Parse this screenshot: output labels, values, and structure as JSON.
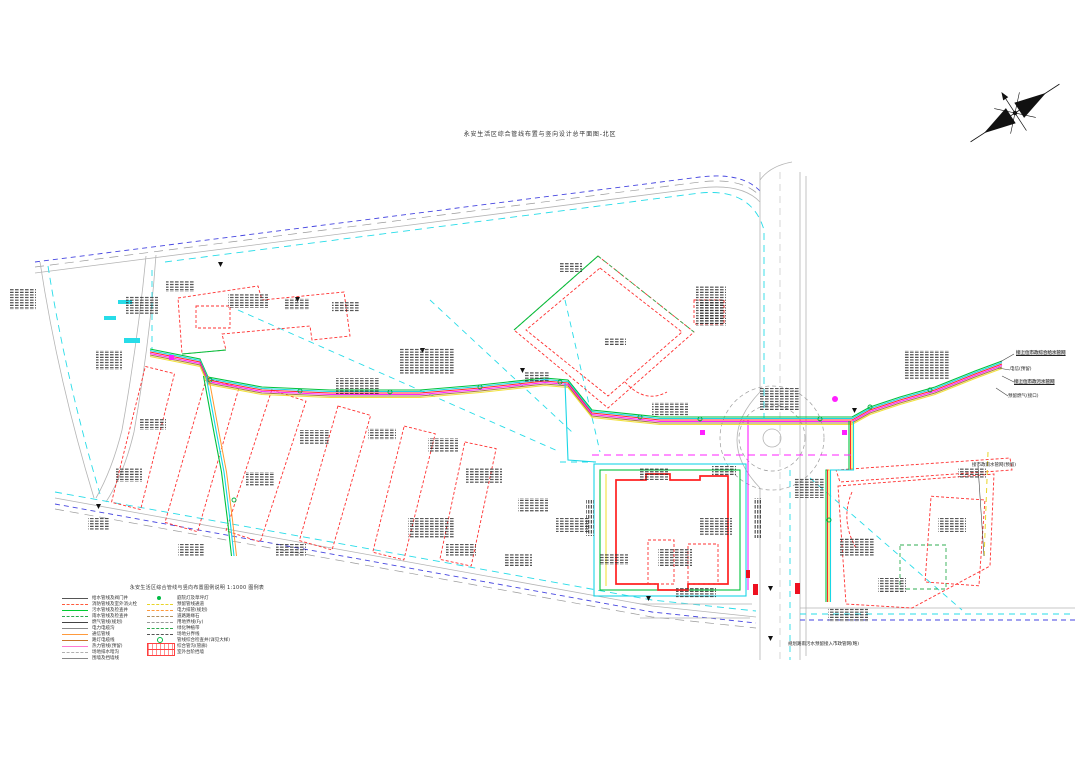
{
  "title": "永安生活区综合管线布置与竖向设计总平面图-北区",
  "compass": {
    "icon": "north-arrow"
  },
  "legend": {
    "title": "永安生活区综合管线与竖向布置图例说明 1:1000 图例表",
    "left_items": [
      {
        "label": "给水管线及阀门井",
        "color": "#555555",
        "style": "solid"
      },
      {
        "label": "消防管线及室外消火栓",
        "color": "#ff5a3c",
        "style": "dashed"
      },
      {
        "label": "污水管线及检查井",
        "color": "#00cc33",
        "style": "solid"
      },
      {
        "label": "雨水管线及检查井",
        "color": "#2fa84f",
        "style": "dashed"
      },
      {
        "label": "燃气管线(规划)",
        "color": "#444444",
        "style": "solid"
      },
      {
        "label": "电力电缆沟",
        "color": "#8a8a8a",
        "style": "solid"
      },
      {
        "label": "通信管线",
        "color": "#ff9a3c",
        "style": "solid"
      },
      {
        "label": "路灯电缆线",
        "color": "#c8742a",
        "style": "solid"
      },
      {
        "label": "热力管线(预留)",
        "color": "#ff7ad2",
        "style": "solid"
      },
      {
        "label": "场地排水暗沟",
        "color": "#b0b0b0",
        "style": "dashed"
      },
      {
        "label": "围墙及挡墙线",
        "color": "#888888",
        "style": "solid"
      }
    ],
    "right_items": [
      {
        "label": "庭院灯及草坪灯",
        "color": "#00bb44",
        "type": "dot"
      },
      {
        "label": "预留管线通道",
        "color": "#e8d428",
        "style": "dashed"
      },
      {
        "label": "电力排管(规划)",
        "color": "#ff9a3c",
        "style": "dashed"
      },
      {
        "label": "道路路缘石",
        "color": "#b09060",
        "style": "dashed"
      },
      {
        "label": "用地界线(Fy)",
        "color": "#9a9a9a",
        "style": "dashed"
      },
      {
        "label": "绿化种植带",
        "color": "#2fa84f",
        "style": "dashed"
      },
      {
        "label": "场地分界线",
        "color": "#555555",
        "style": "dashed"
      },
      {
        "label": "管线综合检查井(详见大样)",
        "color": "#00bb44",
        "type": "ring"
      },
      {
        "label": "综合管沟(管廊)",
        "color": "#ff4040",
        "type": "bar"
      },
      {
        "label": "室外台阶挡墙",
        "color": "#ff4040",
        "type": "bar"
      }
    ]
  },
  "right_labels": [
    {
      "text": "接上位市政综合给水管网",
      "highlight": true
    },
    {
      "text": "电信(预留)",
      "highlight": false
    },
    {
      "text": "接上位市政污水管网",
      "highlight": true
    },
    {
      "text": "预留燃气(接口)",
      "highlight": false
    }
  ],
  "storm_label": "接市政雨水管网(预留)",
  "bottom_note": "规划路雨污水预留接入市政管网(略)",
  "colors": {
    "building_outline": "#ff3030",
    "water": "#00c23c",
    "existing_utility": "#27dce8",
    "heating": "#ff20ff",
    "fire": "#ff2828",
    "telecom": "#a87c46",
    "reserved": "#f2e23c",
    "road": "#b4b4b4",
    "boundary_blue": "#4646e0"
  }
}
